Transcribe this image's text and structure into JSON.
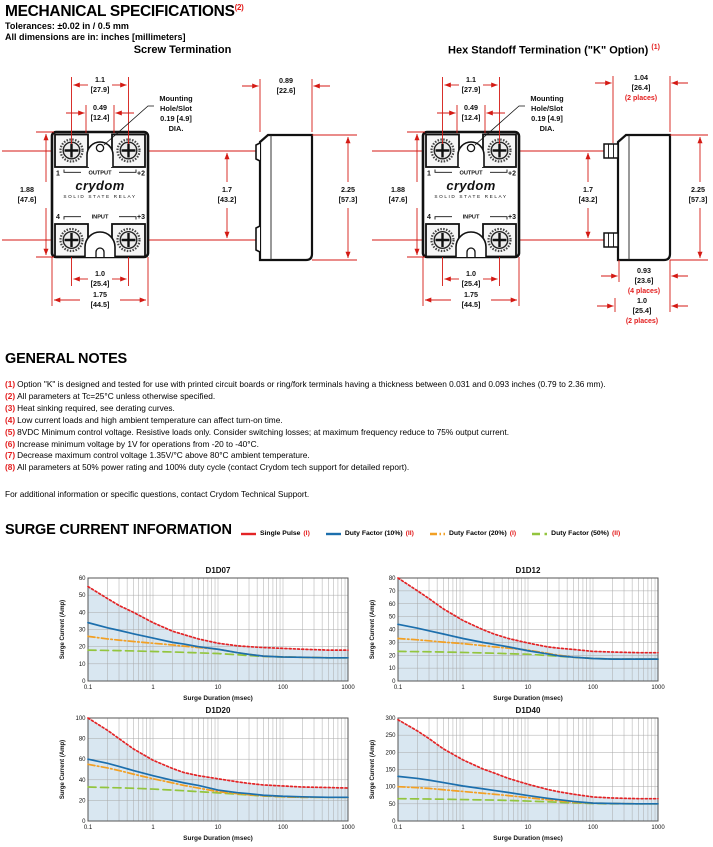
{
  "page": {
    "title": "MECHANICAL SPECIFICATIONS",
    "title_sup": "(2)",
    "tolerances": "Tolerances: ±0.02 in / 0.5 mm",
    "dimensions_note": "All dimensions are in: inches [millimeters]"
  },
  "drawings": {
    "screw_title": "Screw Termination",
    "hex_title": "Hex Standoff Termination (\"K\" Option)",
    "hex_title_sup": "(1)",
    "front": {
      "top_width": "1.1",
      "top_width_mm": "[27.9]",
      "slot_width": "0.49",
      "slot_width_mm": "[12.4]",
      "mounting": [
        "Mounting",
        "Hole/Slot",
        "0.19 [4.9]",
        "DIA."
      ],
      "body_height": "1.88",
      "body_height_mm": "[47.6]",
      "terminal_span": "1.7",
      "terminal_span_mm": "[43.2]",
      "terminal_width": "1.0",
      "terminal_width_mm": "[25.4]",
      "body_width": "1.75",
      "body_width_mm": "[44.5]",
      "total_height": "2.25",
      "total_height_mm": "[57.3]"
    },
    "screw_side": {
      "depth": "0.89",
      "depth_mm": "[22.6]"
    },
    "hex_side": {
      "standoff_width": "1.04",
      "standoff_width_mm": "[26.4]",
      "standoff_width_note": "(2 places)",
      "hex_len": "0.93",
      "hex_len_mm": "[23.6]",
      "hex_len_note": "(4 places)",
      "stud_len": "1.0",
      "stud_len_mm": "[25.4]",
      "stud_len_note": "(2 places)"
    },
    "relay": {
      "pin1": "1",
      "pin2": "+2",
      "pin4": "4",
      "pin3": "+3",
      "output_label": "OUTPUT",
      "input_label": "INPUT",
      "brand": "crydom",
      "brand_sub": "SOLID STATE RELAY"
    }
  },
  "notes": {
    "title": "GENERAL NOTES",
    "items": [
      {
        "num": "(1)",
        "text": "Option \"K\" is designed and tested for use with printed circuit boards or ring/fork terminals having a thickness between 0.031 and 0.093 inches (0.79 to 2.36 mm)."
      },
      {
        "num": "(2)",
        "text": "All parameters at Tc=25°C unless otherwise specified."
      },
      {
        "num": "(3)",
        "text": "Heat sinking required, see derating curves."
      },
      {
        "num": "(4)",
        "text": "Low current loads and high ambient temperature can affect turn-on time."
      },
      {
        "num": "(5)",
        "text": "8VDC Minimum control voltage. Resistive loads only. Consider switching losses; at maximum frequency reduce to 75% output current."
      },
      {
        "num": "(6)",
        "text": "Increase minimum voltage by 1V for operations from -20 to -40°C."
      },
      {
        "num": "(7)",
        "text": "Decrease maximum control voltage 1.35V/°C above 80°C ambient temperature."
      },
      {
        "num": "(8)",
        "text": "All parameters at 50% power rating and 100% duty cycle (contact Crydom tech support for detailed report)."
      }
    ],
    "contact": "For additional information or specific questions, contact Crydom Technical Support."
  },
  "surge": {
    "title": "SURGE CURRENT INFORMATION",
    "legend": [
      {
        "label": "Single Pulse",
        "sup": "(I)",
        "color": "#e32426",
        "line_style": "dotted"
      },
      {
        "label": "Duty Factor (10%)",
        "sup": "(II)",
        "color": "#1c6fad",
        "line_style": "solid"
      },
      {
        "label": "Duty Factor (20%)",
        "sup": "(I)",
        "color": "#f2a024",
        "line_style": "dashdot"
      },
      {
        "label": "Duty Factor (50%)",
        "sup": "(II)",
        "color": "#93c53e",
        "line_style": "dashed"
      }
    ]
  },
  "chart_data": [
    {
      "type": "line",
      "title": "D1D07",
      "xlabel": "Surge Duration (msec)",
      "ylabel": "Surge Current (Amp)",
      "xscale": "log",
      "xlim": [
        0.1,
        1000
      ],
      "ylim": [
        0,
        60
      ],
      "ytick_step": 10,
      "xticks": [
        0.1,
        1,
        10,
        100,
        1000
      ],
      "grid": true,
      "fill_under_series": 0,
      "fill_color": "#d9e7f1",
      "x": [
        0.1,
        0.2,
        0.3,
        0.5,
        1,
        2,
        3,
        5,
        10,
        20,
        30,
        50,
        100,
        200,
        500,
        1000
      ],
      "series": [
        {
          "name": "Single Pulse",
          "color": "#e32426",
          "line_style": "dotted",
          "values": [
            55,
            48,
            44,
            40,
            34,
            29,
            27,
            24.5,
            22,
            20.5,
            20,
            19.5,
            19,
            18.5,
            18,
            18
          ]
        },
        {
          "name": "Duty Factor (10%)",
          "color": "#1c6fad",
          "line_style": "solid",
          "values": [
            34,
            31,
            29.5,
            27.5,
            25,
            22.5,
            21.5,
            20,
            18.5,
            16.5,
            15.5,
            14.5,
            14,
            13.8,
            13.5,
            13.5
          ]
        },
        {
          "name": "Duty Factor (20%)",
          "color": "#f2a024",
          "line_style": "dashdot",
          "values": [
            26,
            24.5,
            23.8,
            23,
            22,
            21,
            20.3,
            19.5,
            18.5,
            16.5,
            15.5,
            14.5,
            14,
            13.8,
            13.5,
            13.5
          ]
        },
        {
          "name": "Duty Factor (50%)",
          "color": "#93c53e",
          "line_style": "dashed",
          "values": [
            18,
            17.8,
            17.7,
            17.5,
            17.2,
            16.9,
            16.7,
            16.4,
            16,
            15.3,
            14.8,
            14.3,
            14,
            13.8,
            13.5,
            13.5
          ]
        }
      ]
    },
    {
      "type": "line",
      "title": "D1D12",
      "xlabel": "Surge Duration (msec)",
      "ylabel": "Surge Current (Amp)",
      "xscale": "log",
      "xlim": [
        0.1,
        1000
      ],
      "ylim": [
        0,
        80
      ],
      "ytick_step": 10,
      "xticks": [
        0.1,
        1,
        10,
        100,
        1000
      ],
      "grid": true,
      "fill_under_series": 0,
      "fill_color": "#d9e7f1",
      "x": [
        0.1,
        0.2,
        0.3,
        0.5,
        1,
        2,
        3,
        5,
        10,
        20,
        30,
        50,
        100,
        200,
        500,
        1000
      ],
      "series": [
        {
          "name": "Single Pulse",
          "color": "#e32426",
          "line_style": "dotted",
          "values": [
            80,
            70,
            64,
            56,
            47,
            40,
            36.5,
            33,
            29.5,
            26.5,
            25.5,
            24.5,
            23,
            22.5,
            22,
            22
          ]
        },
        {
          "name": "Duty Factor (10%)",
          "color": "#1c6fad",
          "line_style": "solid",
          "values": [
            44,
            41,
            39,
            36.5,
            33,
            30,
            28.5,
            26.5,
            23.5,
            21,
            19.5,
            18.5,
            17.5,
            17,
            17,
            17
          ]
        },
        {
          "name": "Duty Factor (20%)",
          "color": "#f2a024",
          "line_style": "dashdot",
          "values": [
            33,
            32,
            31.2,
            30.2,
            29,
            27.5,
            26.5,
            25.5,
            24,
            21.5,
            20,
            18.5,
            17.5,
            17,
            17,
            17
          ]
        },
        {
          "name": "Duty Factor (50%)",
          "color": "#93c53e",
          "line_style": "dashed",
          "values": [
            23,
            22.8,
            22.7,
            22.5,
            22.2,
            21.8,
            21.6,
            21.2,
            20.8,
            19.8,
            19.2,
            18.4,
            17.5,
            17,
            17,
            17
          ]
        }
      ]
    },
    {
      "type": "line",
      "title": "D1D20",
      "xlabel": "Surge Duration (msec)",
      "ylabel": "Surge Current (Amp)",
      "xscale": "log",
      "xlim": [
        0.1,
        1000
      ],
      "ylim": [
        0,
        100
      ],
      "ytick_step": 20,
      "xticks": [
        0.1,
        1,
        10,
        100,
        1000
      ],
      "grid": true,
      "fill_under_series": 0,
      "fill_color": "#d9e7f1",
      "x": [
        0.1,
        0.2,
        0.3,
        0.5,
        1,
        2,
        3,
        5,
        10,
        20,
        30,
        50,
        100,
        200,
        500,
        1000
      ],
      "series": [
        {
          "name": "Single Pulse",
          "color": "#e32426",
          "line_style": "dotted",
          "values": [
            100,
            88,
            80,
            70,
            59,
            51,
            47,
            44,
            41,
            38,
            36.5,
            35,
            34,
            33,
            32.5,
            32
          ]
        },
        {
          "name": "Duty Factor (10%)",
          "color": "#1c6fad",
          "line_style": "solid",
          "values": [
            60,
            56,
            53,
            49,
            44,
            39.5,
            37,
            34.5,
            30,
            27.5,
            26.5,
            25,
            24,
            23.5,
            23,
            23
          ]
        },
        {
          "name": "Duty Factor (20%)",
          "color": "#f2a024",
          "line_style": "dashdot",
          "values": [
            55,
            51.5,
            49,
            45.5,
            41,
            37,
            34.5,
            32,
            28.5,
            26.5,
            25.5,
            24.5,
            23.5,
            23,
            23,
            23
          ]
        },
        {
          "name": "Duty Factor (50%)",
          "color": "#93c53e",
          "line_style": "dashed",
          "values": [
            33,
            32.5,
            32.2,
            31.8,
            31,
            30,
            29.4,
            28.5,
            27.3,
            26,
            25.2,
            24.3,
            23.5,
            23,
            23,
            23
          ]
        }
      ]
    },
    {
      "type": "line",
      "title": "D1D40",
      "xlabel": "Surge Duration (msec)",
      "ylabel": "Surge Current (Amp)",
      "xscale": "log",
      "xlim": [
        0.1,
        1000
      ],
      "ylim": [
        0,
        300
      ],
      "ytick_step": 50,
      "xticks": [
        0.1,
        1,
        10,
        100,
        1000
      ],
      "grid": true,
      "fill_under_series": 0,
      "fill_color": "#d9e7f1",
      "x": [
        0.1,
        0.2,
        0.3,
        0.5,
        1,
        2,
        3,
        5,
        10,
        20,
        30,
        50,
        100,
        200,
        500,
        1000
      ],
      "series": [
        {
          "name": "Single Pulse",
          "color": "#e32426",
          "line_style": "dotted",
          "values": [
            295,
            262,
            240,
            210,
            178,
            152,
            140,
            124,
            107,
            92,
            85,
            78,
            70,
            67,
            65,
            65
          ]
        },
        {
          "name": "Duty Factor (10%)",
          "color": "#1c6fad",
          "line_style": "solid",
          "values": [
            130,
            124,
            119,
            112,
            102,
            94,
            89,
            83,
            74,
            66,
            62,
            57,
            52,
            51,
            50,
            50
          ]
        },
        {
          "name": "Duty Factor (20%)",
          "color": "#f2a024",
          "line_style": "dashdot",
          "values": [
            100,
            97,
            95,
            91,
            86,
            81,
            78,
            74,
            68,
            62,
            59,
            55,
            52,
            51,
            50,
            50
          ]
        },
        {
          "name": "Duty Factor (50%)",
          "color": "#93c53e",
          "line_style": "dashed",
          "values": [
            65,
            64.5,
            64,
            63.5,
            62.5,
            61.5,
            61,
            60,
            58,
            56,
            54.5,
            53,
            51,
            50,
            50,
            50
          ]
        }
      ]
    }
  ]
}
